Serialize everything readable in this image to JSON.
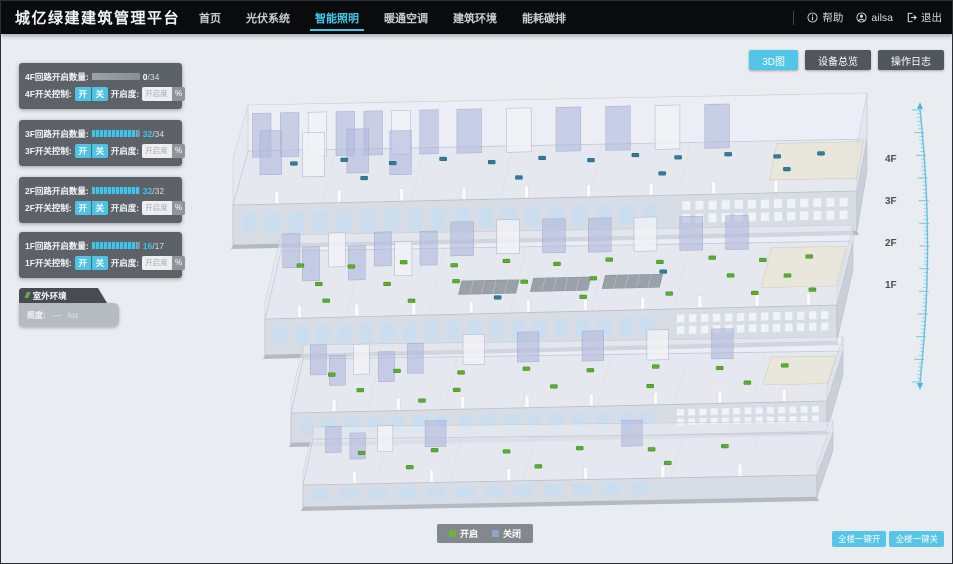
{
  "header": {
    "title": "城亿绿建建筑管理平台",
    "nav": [
      {
        "label": "首页",
        "active": false
      },
      {
        "label": "光伏系统",
        "active": false
      },
      {
        "label": "智能照明",
        "active": true
      },
      {
        "label": "暖通空调",
        "active": false
      },
      {
        "label": "建筑环境",
        "active": false
      },
      {
        "label": "能耗碳排",
        "active": false
      }
    ],
    "help_label": "帮助",
    "user_name": "ailsa",
    "logout_label": "退出"
  },
  "toolbar": {
    "buttons": [
      {
        "label": "3D图",
        "active": true
      },
      {
        "label": "设备总览",
        "active": false
      },
      {
        "label": "操作日志",
        "active": false
      }
    ]
  },
  "floor_panels": [
    {
      "count_label": "4F回路开启数量:",
      "count_value": "0",
      "count_total": "/34",
      "pct": 0,
      "lit": false,
      "switch_label": "4F开关控制:",
      "on_label": "开",
      "off_label": "关",
      "dim_label": "开启度:",
      "dim_placeholder": "开启度",
      "unit_label": "%",
      "top": 62
    },
    {
      "count_label": "3F回路开启数量:",
      "count_value": "32",
      "count_total": "/34",
      "pct": 94,
      "lit": true,
      "switch_label": "3F开关控制:",
      "on_label": "开",
      "off_label": "关",
      "dim_label": "开启度:",
      "dim_placeholder": "开启度",
      "unit_label": "%",
      "top": 119
    },
    {
      "count_label": "2F回路开启数量:",
      "count_value": "32",
      "count_total": "/32",
      "pct": 100,
      "lit": true,
      "switch_label": "2F开关控制:",
      "on_label": "开",
      "off_label": "关",
      "dim_label": "开启度:",
      "dim_placeholder": "开启度",
      "unit_label": "%",
      "top": 176
    },
    {
      "count_label": "1F回路开启数量:",
      "count_value": "16",
      "count_total": "/17",
      "pct": 94,
      "lit": true,
      "switch_label": "1F开关控制:",
      "on_label": "开",
      "off_label": "关",
      "dim_label": "开启度:",
      "dim_placeholder": "开启度",
      "unit_label": "%",
      "top": 231
    }
  ],
  "outdoor_panel": {
    "title": "室外环境",
    "slashes": "///",
    "metric_label": "照度:",
    "metric_value": "—",
    "metric_unit": "lux"
  },
  "floor_labels": [
    {
      "label": "4F",
      "top": 153
    },
    {
      "label": "3F",
      "top": 195
    },
    {
      "label": "2F",
      "top": 237
    },
    {
      "label": "1F",
      "top": 279
    }
  ],
  "legend": {
    "items": [
      {
        "label": "开启",
        "color": "#6db33f"
      },
      {
        "label": "关闭",
        "color": "#8ba6c6"
      }
    ]
  },
  "bulk_buttons": [
    {
      "label": "全楼一键开"
    },
    {
      "label": "全楼一键关"
    }
  ],
  "colors": {
    "accent": "#45c8e8",
    "header_bg": "#0a0b0d",
    "panel_bg": "#494e55",
    "dot_on": "#58b02c",
    "dot_off": "#2f7d9c",
    "canvas_bg": "#e9edf2"
  },
  "building": {
    "floors": [
      {
        "name": "4F",
        "bl": [
          247,
          150
        ],
        "br": [
          866,
          138
        ],
        "fl": [
          232,
          204
        ],
        "fr": [
          856,
          190
        ],
        "faceH": 40,
        "wallH": 46,
        "partH": 44,
        "windows": 18,
        "perf": true,
        "partitions": [
          [
            0.01,
            0.12,
            0.03
          ],
          [
            0.055,
            0.12,
            0.03
          ],
          [
            0.1,
            0.12,
            0.03
          ],
          [
            0.145,
            0.12,
            0.03
          ],
          [
            0.19,
            0.12,
            0.03
          ],
          [
            0.235,
            0.12,
            0.03
          ],
          [
            0.28,
            0.12,
            0.03
          ],
          [
            0.34,
            0.12,
            0.04
          ],
          [
            0.42,
            0.12,
            0.04
          ],
          [
            0.5,
            0.12,
            0.04
          ],
          [
            0.58,
            0.12,
            0.04
          ],
          [
            0.66,
            0.12,
            0.04
          ],
          [
            0.74,
            0.12,
            0.04
          ],
          [
            0.03,
            0.45,
            0.035
          ],
          [
            0.1,
            0.5,
            0.035
          ],
          [
            0.17,
            0.45,
            0.035
          ],
          [
            0.24,
            0.5,
            0.035
          ]
        ],
        "blocks": [
          [
            0.855,
            0.05,
            0.995,
            0.75
          ]
        ],
        "openings": [],
        "dots": [
          [
            0.08,
            0.25,
            "t"
          ],
          [
            0.16,
            0.2,
            "t"
          ],
          [
            0.24,
            0.28,
            "t"
          ],
          [
            0.32,
            0.22,
            "t"
          ],
          [
            0.4,
            0.3,
            "t"
          ],
          [
            0.48,
            0.24,
            "t"
          ],
          [
            0.56,
            0.3,
            "t"
          ],
          [
            0.63,
            0.22,
            "t"
          ],
          [
            0.7,
            0.28,
            "t"
          ],
          [
            0.78,
            0.24,
            "t"
          ],
          [
            0.86,
            0.3,
            "t"
          ],
          [
            0.93,
            0.26,
            "t"
          ],
          [
            0.2,
            0.55,
            "t"
          ],
          [
            0.45,
            0.6,
            "t"
          ],
          [
            0.68,
            0.58,
            "t"
          ],
          [
            0.88,
            0.55,
            "t"
          ]
        ],
        "cols": [
          0.07,
          0.17,
          0.27,
          0.37,
          0.47,
          0.57,
          0.67,
          0.77,
          0.87
        ]
      },
      {
        "name": "3F",
        "bl": [
          280,
          250
        ],
        "br": [
          852,
          240
        ],
        "fl": [
          264,
          318
        ],
        "fr": [
          836,
          304
        ],
        "faceH": 36,
        "wallH": 16,
        "partH": 34,
        "windows": 18,
        "perf": true,
        "partitions": [
          [
            0.01,
            0.25,
            0.03
          ],
          [
            0.05,
            0.45,
            0.03
          ],
          [
            0.09,
            0.25,
            0.03
          ],
          [
            0.13,
            0.45,
            0.03
          ],
          [
            0.17,
            0.25,
            0.03
          ],
          [
            0.21,
            0.4,
            0.03
          ],
          [
            0.25,
            0.25,
            0.03
          ],
          [
            0.3,
            0.12,
            0.04
          ],
          [
            0.38,
            0.1,
            0.04
          ],
          [
            0.46,
            0.1,
            0.04
          ],
          [
            0.54,
            0.1,
            0.04
          ],
          [
            0.62,
            0.1,
            0.04
          ],
          [
            0.7,
            0.1,
            0.04
          ],
          [
            0.78,
            0.1,
            0.04
          ]
        ],
        "blocks": [
          [
            0.86,
            0.08,
            0.99,
            0.7
          ]
        ],
        "openings": [
          [
            0.33,
            0.5,
            0.1,
            0.2
          ],
          [
            0.455,
            0.48,
            0.1,
            0.2
          ],
          [
            0.58,
            0.46,
            0.1,
            0.2
          ]
        ],
        "dots": [
          [
            0.04,
            0.22,
            "g"
          ],
          [
            0.13,
            0.25,
            "g"
          ],
          [
            0.22,
            0.2,
            "g"
          ],
          [
            0.31,
            0.26,
            "g"
          ],
          [
            0.4,
            0.21,
            "g"
          ],
          [
            0.49,
            0.27,
            "g"
          ],
          [
            0.58,
            0.22,
            "g"
          ],
          [
            0.67,
            0.27,
            "g"
          ],
          [
            0.76,
            0.22,
            "g"
          ],
          [
            0.85,
            0.27,
            "g"
          ],
          [
            0.93,
            0.23,
            "g"
          ],
          [
            0.08,
            0.5,
            "g"
          ],
          [
            0.2,
            0.52,
            "g"
          ],
          [
            0.32,
            0.5,
            "g"
          ],
          [
            0.44,
            0.53,
            "g"
          ],
          [
            0.56,
            0.5,
            "g"
          ],
          [
            0.68,
            0.42,
            "t"
          ],
          [
            0.8,
            0.5,
            "g"
          ],
          [
            0.9,
            0.52,
            "g"
          ],
          [
            0.1,
            0.75,
            "g"
          ],
          [
            0.25,
            0.78,
            "g"
          ],
          [
            0.4,
            0.76,
            "t"
          ],
          [
            0.55,
            0.78,
            "g"
          ],
          [
            0.7,
            0.76,
            "g"
          ],
          [
            0.85,
            0.78,
            "g"
          ],
          [
            0.95,
            0.75,
            "g"
          ]
        ],
        "cols": [
          0.06,
          0.16,
          0.26,
          0.36,
          0.46,
          0.56,
          0.66,
          0.76,
          0.86,
          0.95
        ]
      },
      {
        "name": "2F",
        "bl": [
          302,
          358
        ],
        "br": [
          842,
          350
        ],
        "fl": [
          290,
          412
        ],
        "fr": [
          826,
          400
        ],
        "faceH": 30,
        "wallH": 14,
        "partH": 30,
        "windows": 16,
        "perf": true,
        "partitions": [
          [
            0.02,
            0.3,
            0.03
          ],
          [
            0.06,
            0.5,
            0.03
          ],
          [
            0.1,
            0.3,
            0.03
          ],
          [
            0.15,
            0.45,
            0.03
          ],
          [
            0.2,
            0.3,
            0.03
          ],
          [
            0.3,
            0.15,
            0.04
          ],
          [
            0.4,
            0.12,
            0.04
          ],
          [
            0.52,
            0.12,
            0.04
          ],
          [
            0.64,
            0.12,
            0.04
          ],
          [
            0.76,
            0.12,
            0.04
          ]
        ],
        "blocks": [
          [
            0.87,
            0.1,
            0.99,
            0.65
          ]
        ],
        "openings": [],
        "dots": [
          [
            0.06,
            0.3,
            "g"
          ],
          [
            0.18,
            0.25,
            "g"
          ],
          [
            0.3,
            0.3,
            "g"
          ],
          [
            0.42,
            0.25,
            "g"
          ],
          [
            0.54,
            0.3,
            "g"
          ],
          [
            0.66,
            0.25,
            "g"
          ],
          [
            0.78,
            0.3,
            "g"
          ],
          [
            0.9,
            0.27,
            "g"
          ],
          [
            0.12,
            0.6,
            "g"
          ],
          [
            0.3,
            0.63,
            "g"
          ],
          [
            0.48,
            0.6,
            "g"
          ],
          [
            0.66,
            0.63,
            "g"
          ],
          [
            0.84,
            0.6,
            "g"
          ],
          [
            0.24,
            0.82,
            "g"
          ]
        ],
        "cols": [
          0.08,
          0.2,
          0.32,
          0.44,
          0.56,
          0.68,
          0.8,
          0.92
        ]
      },
      {
        "name": "1F",
        "bl": [
          312,
          438
        ],
        "br": [
          832,
          432
        ],
        "fl": [
          302,
          484
        ],
        "fr": [
          816,
          474
        ],
        "faceH": 22,
        "wallH": 12,
        "partH": 26,
        "windows": 12,
        "perf": false,
        "partitions": [
          [
            0.03,
            0.3,
            0.03
          ],
          [
            0.08,
            0.45,
            0.03
          ],
          [
            0.13,
            0.3,
            0.03
          ],
          [
            0.22,
            0.2,
            0.04
          ],
          [
            0.6,
            0.25,
            0.04
          ]
        ],
        "blocks": [],
        "openings": [],
        "dots": [
          [
            0.1,
            0.32,
            "g"
          ],
          [
            0.24,
            0.28,
            "g"
          ],
          [
            0.38,
            0.33,
            "g"
          ],
          [
            0.52,
            0.28,
            "g"
          ],
          [
            0.66,
            0.33,
            "g"
          ],
          [
            0.8,
            0.28,
            "g"
          ],
          [
            0.2,
            0.65,
            "g"
          ],
          [
            0.45,
            0.68,
            "g"
          ],
          [
            0.7,
            0.65,
            "g"
          ]
        ],
        "cols": [
          0.1,
          0.25,
          0.4,
          0.55,
          0.7,
          0.85
        ]
      }
    ]
  }
}
